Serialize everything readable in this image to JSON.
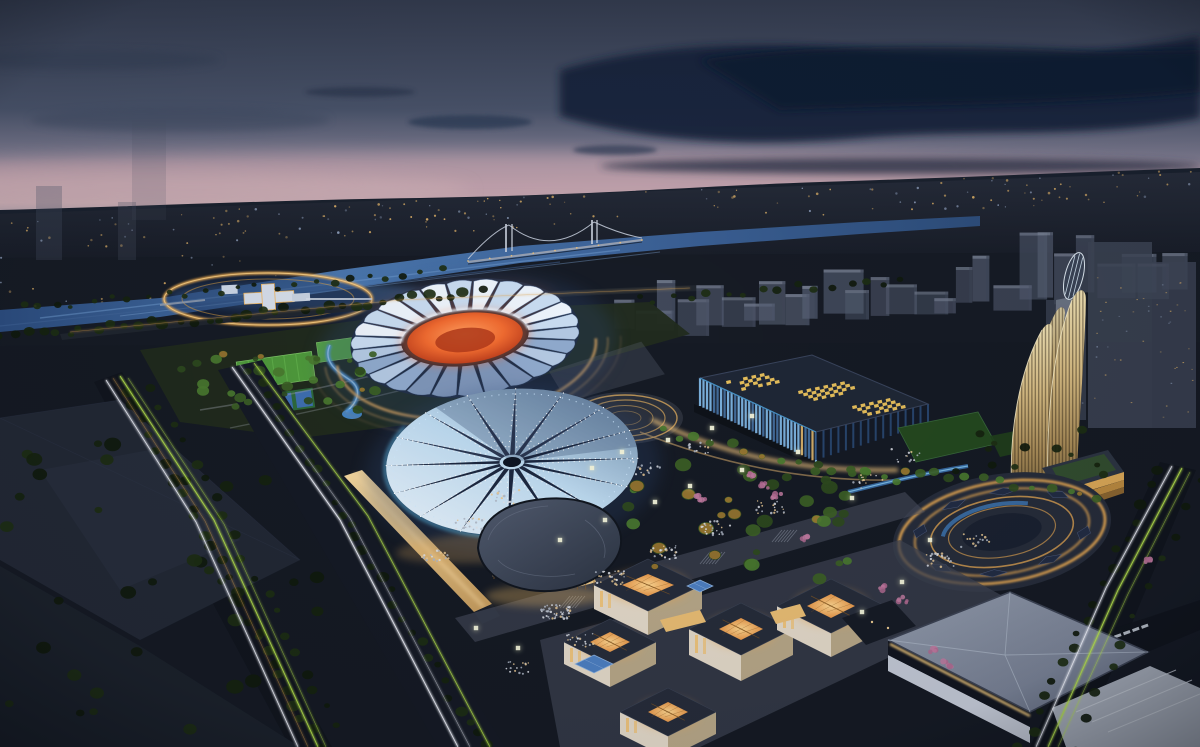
{
  "image": {
    "kind": "architectural-night-aerial-rendering",
    "subject": "sports-park-complex-at-dusk",
    "width": 1200,
    "height": 747
  },
  "palette": {
    "skyTop": "#343c50",
    "skyMid": "#4b5469",
    "horizonPink": "#c2a3ae",
    "cloudDark": "#12203a",
    "cityBand": "#232936",
    "ground": "#151a24",
    "river": "#2c4d80",
    "riverLight": "#6f9bd0",
    "ringGold": "#f3b054",
    "ghostBox": "#565f74",
    "petalLight": "#ecf3fb",
    "petalShade": "#8fa9cc",
    "bowlOrange": "#ef6a30",
    "arenaPanelLight": "#eef7ff",
    "arenaSpike": "#18223a",
    "arenaBaseGold": "#f2c368",
    "arenaBlueGlow": "#5ec1f2",
    "expoRoof": "#1f2736",
    "expoSkylight": "#f0c65e",
    "expoFin": "#7fb6e4",
    "towerWarm": "#d8bd84",
    "beanRoof": "#49536a",
    "beanGlass": "#f4cf8e",
    "pavilionWall": "#e8decb",
    "pavilionGlow": "#f4a94e",
    "whiteRoof": "#8b94a6",
    "roadDark": "#11151e",
    "trailGreen": "#b6e24e",
    "trailWhite": "#f4f7ff",
    "trailWarm": "#e0a855",
    "treeDark": "#16230f",
    "treeLit": "#3c5f26",
    "lawnGreen": "#4f9a3c",
    "courtBlue": "#3e6fb0",
    "flowerPink": "#b06a90",
    "crowdLight": "#dfe3ea",
    "cubeLight": "#f2f3da",
    "cream": "#e3d9c9"
  },
  "scene": {
    "city_lights": {
      "count": 185
    },
    "ghost_city": {
      "count": 27
    },
    "stadium": {
      "cx": 465,
      "cy": 338,
      "innerRx": 62,
      "innerRy": 27,
      "outerRx": 112,
      "outerRy": 56,
      "petals": 26
    },
    "star_arena": {
      "cx": 512,
      "cy": 462,
      "rx": 126,
      "ry": 73,
      "points": 16
    },
    "expo": {
      "fins": 34,
      "skylight_clusters": [
        {
          "x": 726,
          "y": 381,
          "nu": 5,
          "nv": 4
        },
        {
          "x": 798,
          "y": 391,
          "nu": 6,
          "nv": 4
        },
        {
          "x": 852,
          "y": 406,
          "nu": 5,
          "nv": 4
        }
      ]
    },
    "oval_plaza": {
      "cx": 1002,
      "cy": 532,
      "rot": -9,
      "rings": [
        [
          104,
          50,
          2.6,
          0.95
        ],
        [
          88,
          42,
          2.0,
          0.8
        ],
        [
          72,
          34,
          1.6,
          0.7
        ],
        [
          54,
          25,
          1.2,
          0.6
        ]
      ],
      "canopy_angles": [
        20,
        60,
        100,
        140,
        200,
        240,
        275,
        315
      ]
    },
    "ring_plaza": {
      "cx": 268,
      "cy": 299,
      "rx": 104,
      "ry": 26
    },
    "pavilions": [
      {
        "c": [
          648,
          585
        ],
        "dx": 54,
        "dy": 26,
        "h": 24,
        "open": [
          26,
          11
        ]
      },
      {
        "c": [
          610,
          642
        ],
        "dx": 46,
        "dy": 23,
        "h": 22,
        "open": [
          20,
          10
        ]
      },
      {
        "c": [
          741,
          629
        ],
        "dx": 52,
        "dy": 26,
        "h": 26,
        "open": [
          22,
          11
        ]
      },
      {
        "c": [
          831,
          606
        ],
        "dx": 54,
        "dy": 27,
        "h": 24,
        "open": [
          24,
          12
        ]
      },
      {
        "c": [
          668,
          712
        ],
        "dx": 48,
        "dy": 24,
        "h": 22,
        "open": [
          20,
          10
        ]
      }
    ],
    "blue_skylights": [
      {
        "c": [
          594,
          664
        ],
        "dx": 19,
        "dy": 9
      },
      {
        "c": [
          700,
          586
        ],
        "dx": 13,
        "dy": 6
      }
    ],
    "trails": [
      {
        "pts": [
          [
            120,
            376
          ],
          [
            214,
            520
          ],
          [
            318,
            747
          ]
        ],
        "color": "trailGreen",
        "w": 1.7,
        "op": 0.95
      },
      {
        "pts": [
          [
            128,
            378
          ],
          [
            224,
            524
          ],
          [
            326,
            747
          ]
        ],
        "color": "trailGreen",
        "w": 1.1,
        "op": 0.6
      },
      {
        "pts": [
          [
            106,
            380
          ],
          [
            196,
            522
          ],
          [
            298,
            747
          ]
        ],
        "color": "trailWhite",
        "w": 1.6,
        "op": 0.9
      },
      {
        "pts": [
          [
            113,
            378
          ],
          [
            205,
            521
          ],
          [
            308,
            747
          ]
        ],
        "color": "trailWarm",
        "w": 1.0,
        "op": 0.55
      },
      {
        "pts": [
          [
            232,
            367
          ],
          [
            340,
            520
          ],
          [
            458,
            747
          ]
        ],
        "color": "trailWhite",
        "w": 1.8,
        "op": 0.9
      },
      {
        "pts": [
          [
            240,
            365
          ],
          [
            350,
            518
          ],
          [
            470,
            747
          ]
        ],
        "color": "trailWhite",
        "w": 1.1,
        "op": 0.55
      },
      {
        "pts": [
          [
            254,
            363
          ],
          [
            368,
            516
          ],
          [
            490,
            747
          ]
        ],
        "color": "trailGreen",
        "w": 1.4,
        "op": 0.85
      },
      {
        "pts": [
          [
            1182,
            468
          ],
          [
            1118,
            590
          ],
          [
            1048,
            747
          ]
        ],
        "color": "trailGreen",
        "w": 1.8,
        "op": 0.95
      },
      {
        "pts": [
          [
            1190,
            472
          ],
          [
            1128,
            594
          ],
          [
            1058,
            747
          ]
        ],
        "color": "trailGreen",
        "w": 1.1,
        "op": 0.6
      },
      {
        "pts": [
          [
            1172,
            466
          ],
          [
            1106,
            588
          ],
          [
            1036,
            747
          ]
        ],
        "color": "trailWhite",
        "w": 1.6,
        "op": 0.9
      },
      {
        "pts": [
          [
            70,
            332
          ],
          [
            400,
            300
          ],
          [
            690,
            288
          ]
        ],
        "color": "trailWarm",
        "w": 1.0,
        "op": 0.5
      }
    ],
    "tree_lines": [
      {
        "from": [
          0,
          338
        ],
        "to": [
          480,
          292
        ],
        "n": 36,
        "r": 4.5,
        "tone": "dark"
      },
      {
        "from": [
          20,
          308
        ],
        "to": [
          440,
          272
        ],
        "n": 24,
        "r": 3.2,
        "tone": "dark"
      },
      {
        "from": [
          128,
          392
        ],
        "to": [
          318,
          747
        ],
        "n": 26,
        "r": 5.0,
        "tone": "dark"
      },
      {
        "from": [
          152,
          386
        ],
        "to": [
          348,
          747
        ],
        "n": 20,
        "r": 4.2,
        "tone": "dark"
      },
      {
        "from": [
          252,
          368
        ],
        "to": [
          482,
          747
        ],
        "n": 30,
        "r": 4.6,
        "tone": "dark"
      },
      {
        "from": [
          640,
          300
        ],
        "to": [
          900,
          280
        ],
        "n": 16,
        "r": 3.6,
        "tone": "dark"
      },
      {
        "from": [
          660,
          432
        ],
        "to": [
          900,
          482
        ],
        "n": 15,
        "r": 4.2,
        "tone": "lit"
      },
      {
        "from": [
          1158,
          472
        ],
        "to": [
          1022,
          747
        ],
        "n": 18,
        "r": 4.6,
        "tone": "dark"
      },
      {
        "from": [
          1196,
          482
        ],
        "to": [
          1072,
          747
        ],
        "n": 11,
        "r": 4.0,
        "tone": "dark"
      },
      {
        "from": [
          902,
          468
        ],
        "to": [
          1100,
          498
        ],
        "n": 13,
        "r": 4.0,
        "tone": "lit"
      }
    ],
    "tree_patches": [
      {
        "x": 180,
        "y": 348,
        "w": 200,
        "h": 66,
        "n": 30,
        "r": 4.5,
        "tone": "lit"
      },
      {
        "x": 620,
        "y": 460,
        "w": 250,
        "h": 120,
        "n": 38,
        "r": 6.0,
        "tone": "lit"
      },
      {
        "x": 0,
        "y": 430,
        "w": 330,
        "h": 300,
        "n": 36,
        "r": 6.5,
        "tone": "dark"
      },
      {
        "x": 940,
        "y": 425,
        "w": 170,
        "h": 55,
        "n": 12,
        "r": 4.0,
        "tone": "dark"
      }
    ],
    "crowds": [
      [
        555,
        612,
        44
      ],
      [
        610,
        578,
        30
      ],
      [
        662,
        552,
        26
      ],
      [
        715,
        528,
        22
      ],
      [
        770,
        508,
        20
      ],
      [
        470,
        525,
        26
      ],
      [
        435,
        555,
        18
      ],
      [
        505,
        497,
        18
      ],
      [
        940,
        560,
        22
      ],
      [
        975,
        540,
        16
      ],
      [
        868,
        482,
        14
      ],
      [
        645,
        468,
        16
      ],
      [
        698,
        447,
        14
      ],
      [
        582,
        640,
        20
      ],
      [
        520,
        668,
        16
      ],
      [
        905,
        455,
        12
      ]
    ],
    "light_cubes": [
      [
        592,
        468
      ],
      [
        622,
        452
      ],
      [
        668,
        440
      ],
      [
        712,
        428
      ],
      [
        752,
        416
      ],
      [
        690,
        486
      ],
      [
        742,
        470
      ],
      [
        798,
        452
      ],
      [
        852,
        498
      ],
      [
        902,
        582
      ],
      [
        862,
        612
      ],
      [
        930,
        540
      ],
      [
        655,
        502
      ],
      [
        605,
        520
      ],
      [
        560,
        540
      ],
      [
        476,
        628
      ],
      [
        518,
        648
      ]
    ],
    "flowers": [
      [
        753,
        474
      ],
      [
        764,
        485
      ],
      [
        777,
        496
      ],
      [
        884,
        588
      ],
      [
        902,
        600
      ],
      [
        934,
        650
      ],
      [
        948,
        664
      ],
      [
        806,
        538
      ],
      [
        700,
        498
      ],
      [
        1146,
        560
      ]
    ]
  }
}
